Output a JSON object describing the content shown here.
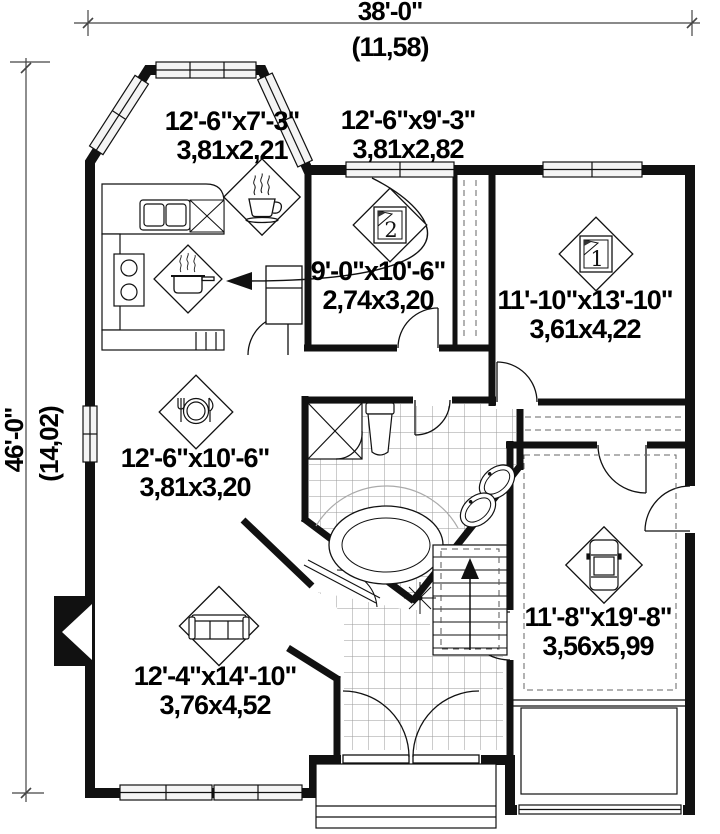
{
  "plan": {
    "overall": {
      "width_ft": "38'-0\"",
      "width_m": "(11,58)",
      "depth_ft": "46'-0\"",
      "depth_m": "(14,02)"
    },
    "rooms": [
      {
        "id": "dinette",
        "icon": "coffee-cup-icon",
        "size_ft": "12'-6\"x7'-3\"",
        "size_m": "3,81x2,21"
      },
      {
        "id": "kitchen",
        "icon": "cooking-pot-icon",
        "size_ft": "12'-6\"x9'-3\"",
        "size_m": "3,81x2,82"
      },
      {
        "id": "bedroom-2",
        "icon": "bed-icon",
        "number": "2",
        "size_ft": "9'-0\"x10'-6\"",
        "size_m": "2,74x3,20"
      },
      {
        "id": "bedroom-1",
        "icon": "bed-icon",
        "number": "1",
        "size_ft": "11'-10\"x13'-10\"",
        "size_m": "3,61x4,22"
      },
      {
        "id": "dining",
        "icon": "cutlery-plate-icon",
        "size_ft": "12'-6\"x10'-6\"",
        "size_m": "3,81x3,20"
      },
      {
        "id": "living",
        "icon": "sofa-icon",
        "size_ft": "12'-4\"x14'-10\"",
        "size_m": "3,76x4,52"
      },
      {
        "id": "garage",
        "icon": "car-icon",
        "size_ft": "11'-8\"x19'-8\"",
        "size_m": "3,56x5,99"
      }
    ],
    "colors": {
      "wall": "#111111",
      "thin_line": "#333333",
      "tile_line": "#9a9a9a",
      "window_fill": "#f4f4f4"
    }
  }
}
